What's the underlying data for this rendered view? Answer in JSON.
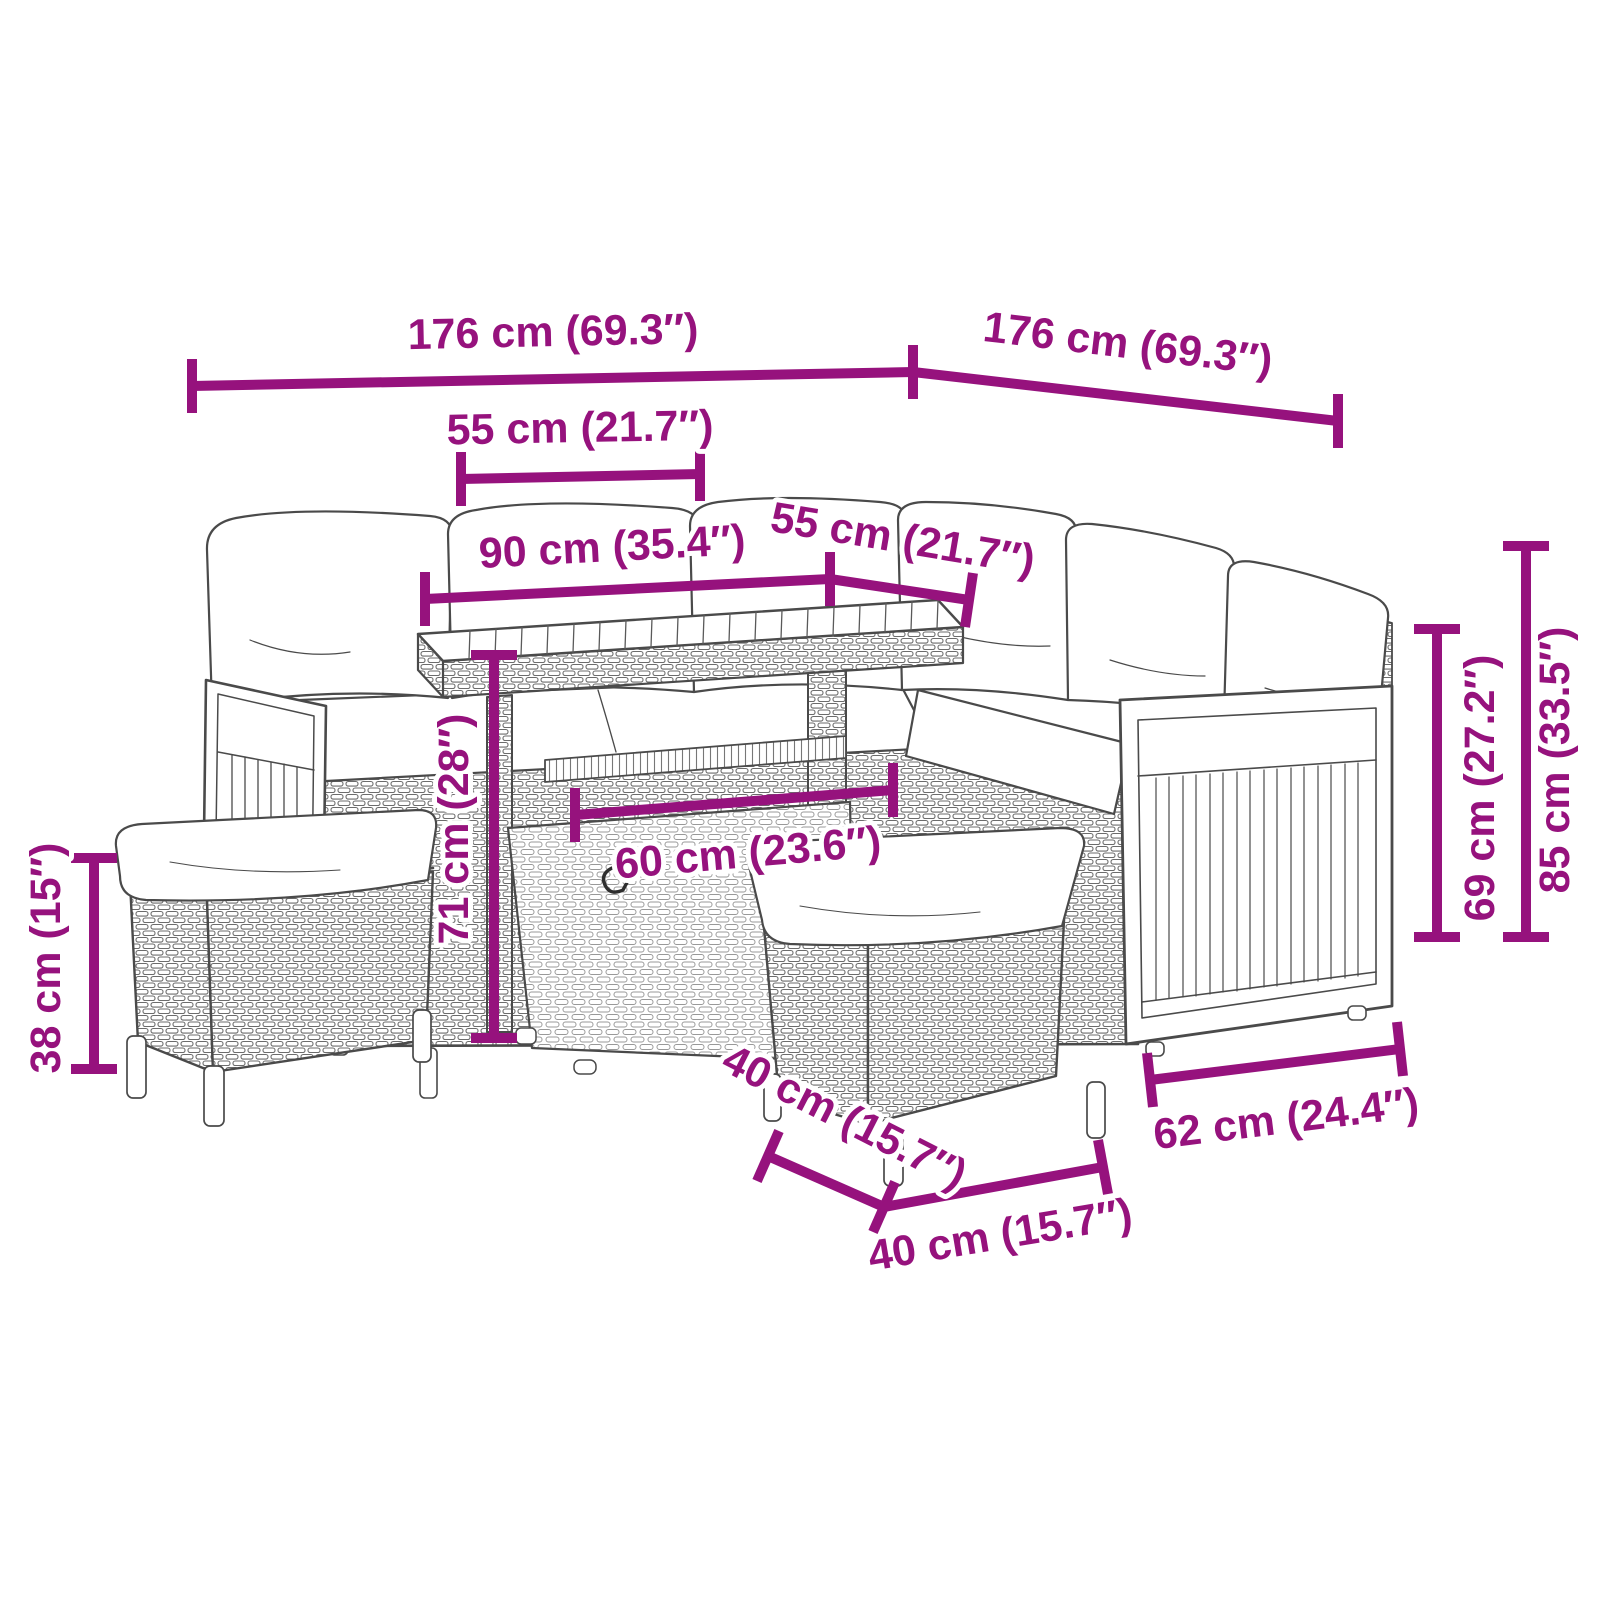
{
  "diagram": {
    "background_color": "#ffffff",
    "accent_color": "#96127D",
    "sketch_line_color": "#4a4a4a",
    "dimensions": [
      {
        "id": "overall-width-left",
        "label": "176 cm (69.3″)"
      },
      {
        "id": "overall-depth-right",
        "label": "176 cm (69.3″)"
      },
      {
        "id": "seat-depth-left",
        "label": "55 cm (21.7″)"
      },
      {
        "id": "table-top-length",
        "label": "90 cm (35.4″)"
      },
      {
        "id": "seat-depth-right",
        "label": "55 cm (21.7″)"
      },
      {
        "id": "table-height",
        "label": "71 cm (28″)"
      },
      {
        "id": "table-top-depth",
        "label": "60 cm (23.6″)"
      },
      {
        "id": "stool-height",
        "label": "38 cm (15″)"
      },
      {
        "id": "armrest-height",
        "label": "69 cm (27.2″)"
      },
      {
        "id": "backrest-height",
        "label": "85 cm (33.5″)"
      },
      {
        "id": "stool-depth",
        "label": "40 cm (15.7″)"
      },
      {
        "id": "stool-width",
        "label": "40 cm (15.7″)"
      },
      {
        "id": "side-panel-width",
        "label": "62 cm (24.4″)"
      }
    ]
  }
}
